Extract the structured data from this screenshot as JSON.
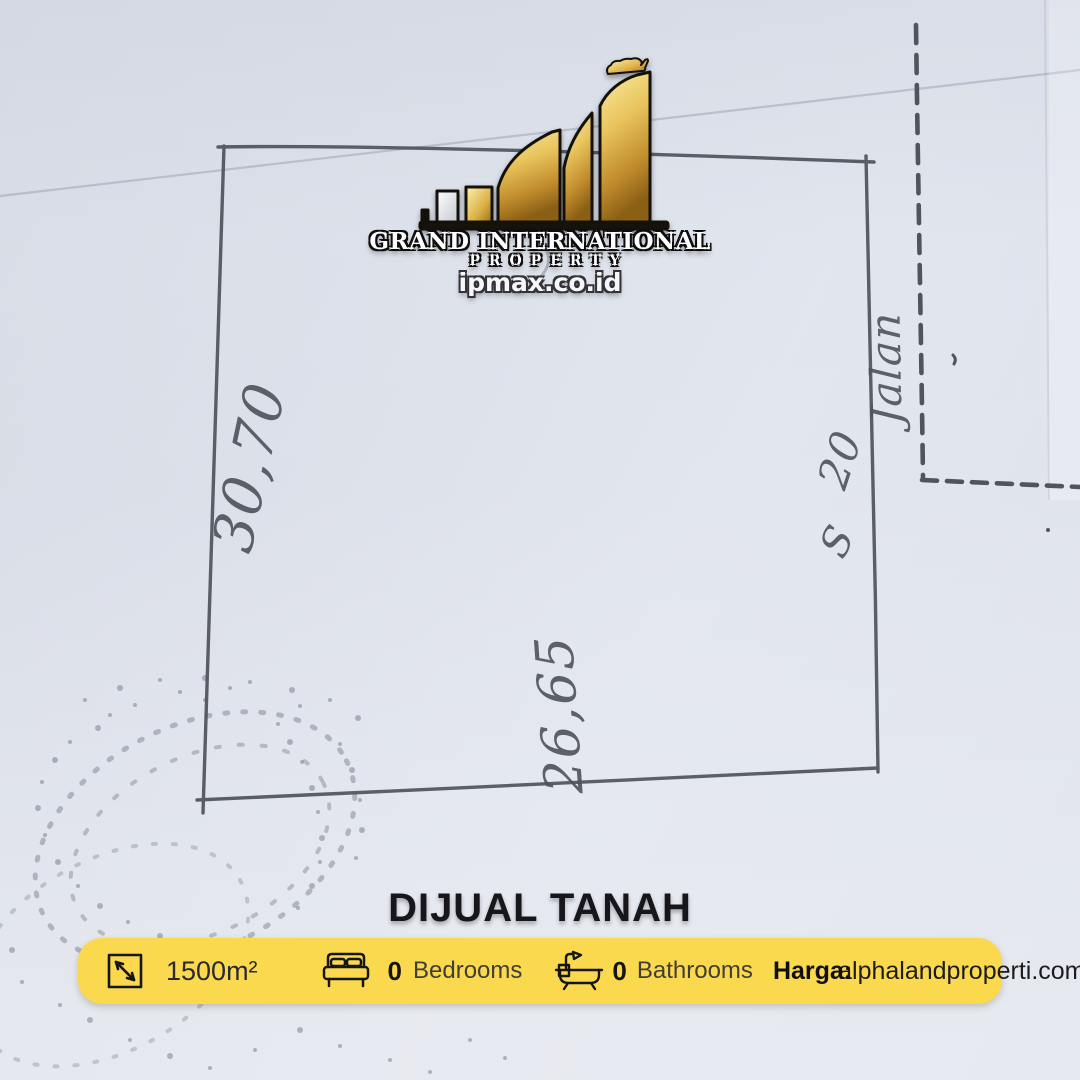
{
  "brand": {
    "name_line1": "GRAND INTERNATIONAL",
    "name_line2": "PROPERTY",
    "website": "ipmax.co.id"
  },
  "sketch": {
    "dim_left": "30,70",
    "dim_bottom": "26,65",
    "dim_right": "20",
    "dim_right_flourish": "S",
    "road_label": "Jalan"
  },
  "listing": {
    "title": "DIJUAL TANAH",
    "area_value": "1500m²",
    "bedrooms_value": "0",
    "bedrooms_label": "Bedrooms",
    "bathrooms_value": "0",
    "bathrooms_label": "Bathrooms",
    "price_label": "Harga:",
    "agency_website": "alphalandproperti.com"
  },
  "icons": {
    "area": "square-diagonal-arrow-icon",
    "bed": "bed-icon",
    "bath": "bathtub-icon",
    "lion": "lion-icon",
    "logo": "rising-bars-one-icon"
  },
  "colors": {
    "bar_yellow": "#FBD94F",
    "paper": "#DDE1EA",
    "ink": "#4D525B",
    "gold": "#D2A24C",
    "title_text": "#16161B"
  }
}
